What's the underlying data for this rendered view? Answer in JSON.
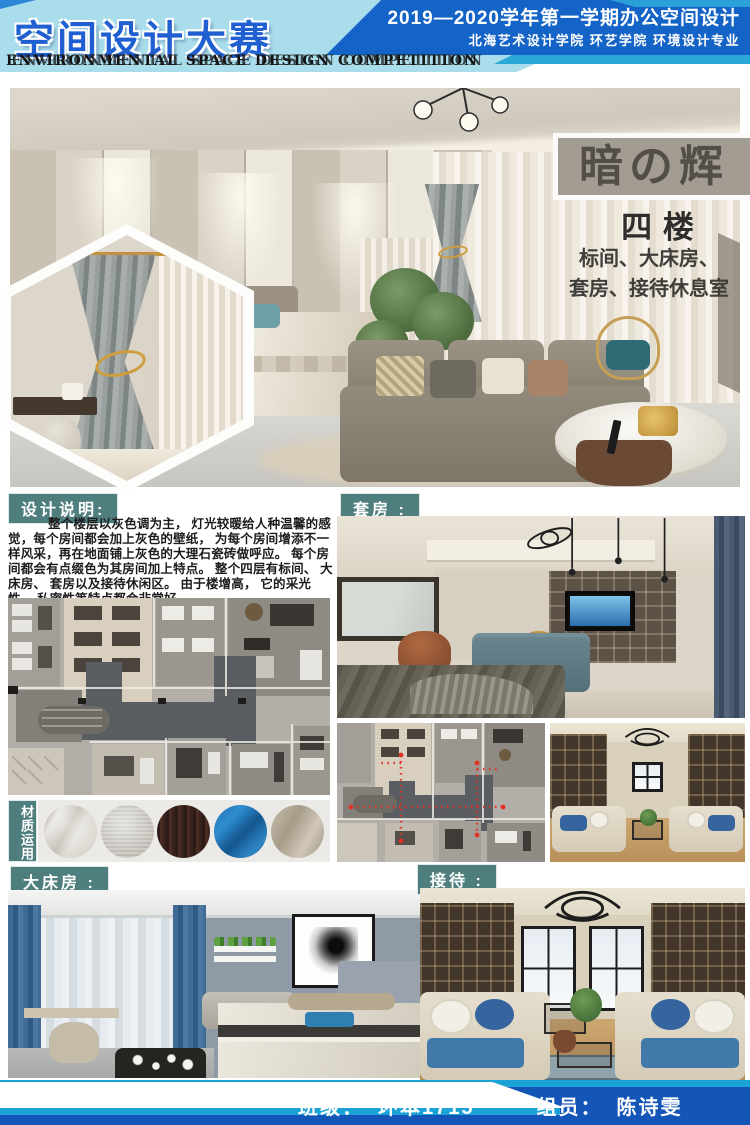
{
  "header": {
    "title_cn": "空间设计大赛",
    "title_en": "ENVIRONMENTAL SPACE DESIGN COMPETITION",
    "course_line": "2019—2020学年第一学期办公空间设计",
    "school_line": "北海艺术设计学院  环艺学院  环境设计专业"
  },
  "hero": {
    "project_title": "暗の辉",
    "floor_label": "四  楼",
    "rooms_line1": "标间、大床房、",
    "rooms_line2": "套房、接待休息室"
  },
  "design_note": {
    "label": "设计说明:",
    "body": "整个楼层以灰色调为主， 灯光较暖给人种温馨的感觉，每个房间都会加上灰色的壁纸， 为每个房间增添不一样风采，再在地面铺上灰色的大理石瓷砖做呼应。 每个房间都会有点缀色为其房间加上特点。 整个四层有标间、 大床房、 套房以及接待休闲区。 由于楼增高， 它的采光性， 私密性等特点都会非常好。"
  },
  "section_labels": {
    "suite": "套房 :",
    "materials": "材质运用",
    "king_room": "大床房 :",
    "reception": "接待 :"
  },
  "materials": {
    "swatches": [
      "marble",
      "gray-fabric",
      "dark-wood",
      "blue-fabric",
      "taupe-fabric"
    ]
  },
  "footer": {
    "class_label": "班级：",
    "class_value": "环本1715",
    "member_label": "组员：",
    "member_value": "陈诗雯"
  },
  "colors": {
    "header_light_blue": "#a9ddeb",
    "header_dark_blue": "#1463c6",
    "cyan_accent": "#2ba7d7",
    "title_blue": "#1f5fd0",
    "teal_label": "#4e7f7e",
    "title_box_gray": "#a39c93",
    "footer_blue": "#1356b8"
  }
}
